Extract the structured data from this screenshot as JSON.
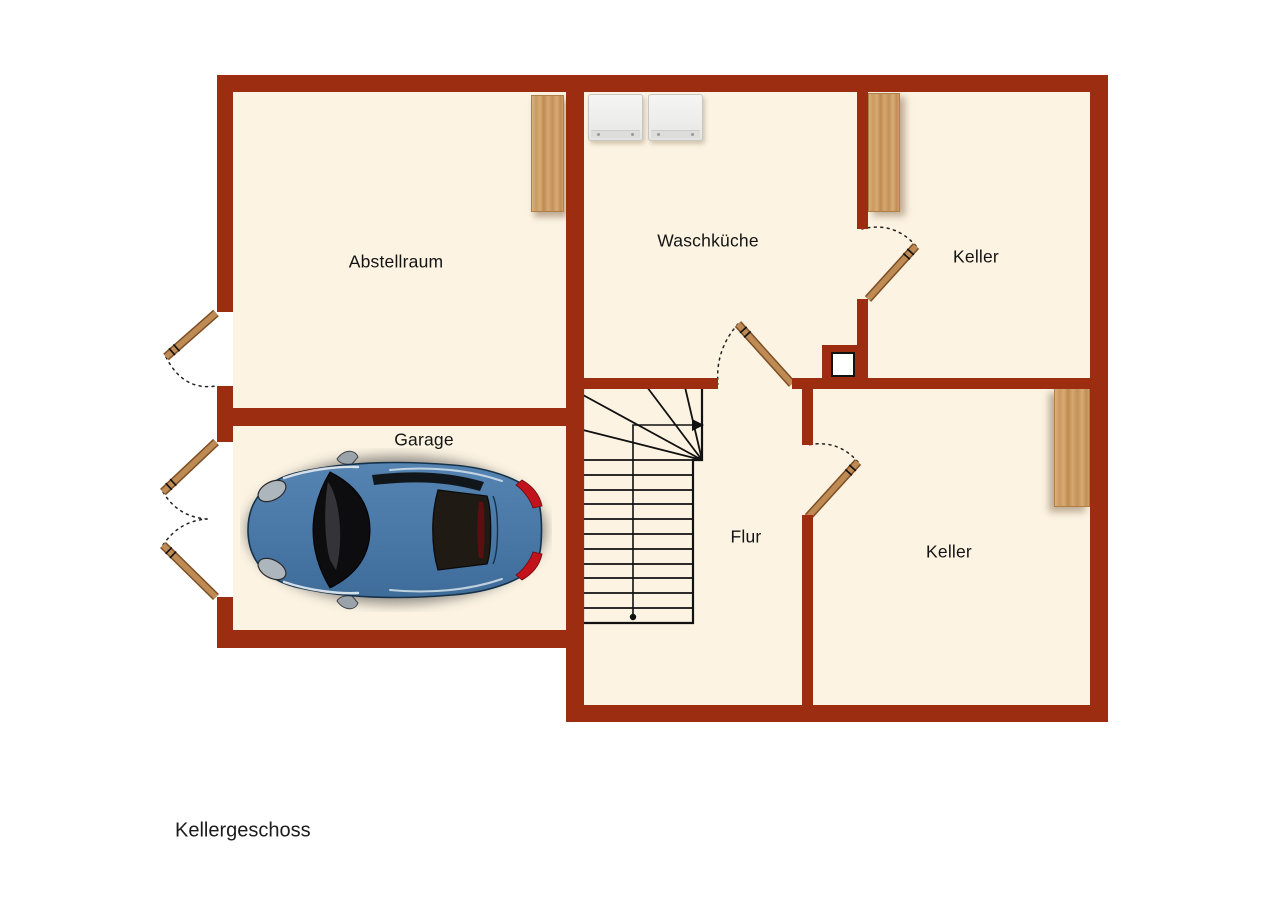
{
  "title": "Kellergeschoss",
  "colors": {
    "wall": "#9c2d11",
    "floor": "#fcf3e2",
    "outside": "#ffffff",
    "wood_door": "#bf8b55",
    "wood_door_edge": "#7d4e24",
    "shelf_wood": "#cf9f68",
    "stair_line": "#111111",
    "label": "#141414",
    "car_body": "#4a79a8",
    "taillight": "#c2121c"
  },
  "rooms": [
    {
      "id": "abstellraum",
      "label": "Abstellraum"
    },
    {
      "id": "waschkueche",
      "label": "Waschküche"
    },
    {
      "id": "keller_top",
      "label": "Keller"
    },
    {
      "id": "garage",
      "label": "Garage"
    },
    {
      "id": "flur",
      "label": "Flur"
    },
    {
      "id": "keller_bottom",
      "label": "Keller"
    }
  ],
  "symbols": {
    "staircase": "u-shaped-stair-with-winders-and-walkline-arrow",
    "doors": "wood-door-leaf-with-dotted-swing-arc (6 total: 1 exterior, 1 double garage, 3 interior)",
    "washing_machines": "2 top-view white appliances in Waschküche",
    "wooden_shelves": "3 wood boards against walls",
    "chimney": "masonry block with white flue opening",
    "car": "blue sports car top view in Garage"
  }
}
